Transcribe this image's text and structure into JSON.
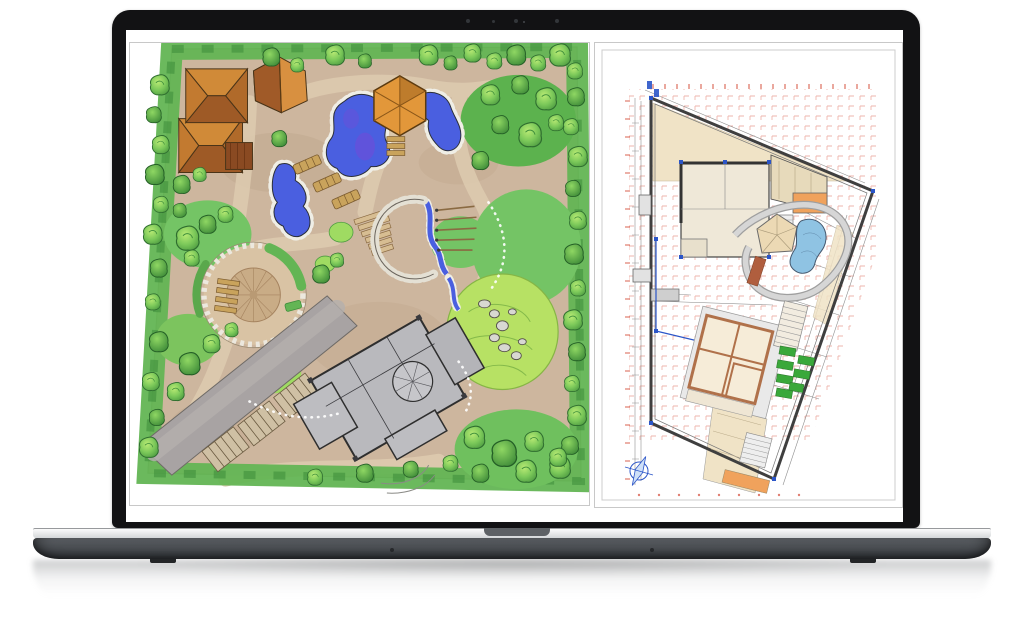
{
  "labels": {
    "laptop": "Laptop displaying a landscape design project",
    "screen": "Split screen with two garden plan images",
    "left_panel": "Hand-drawn landscape masterplan sketch with ponds, gazebo, houses and gray villa footprint",
    "right_panel": "CAD site plan drawing with red dimension grid, pool, gazebo and planting beds",
    "webcam": "webcam-dot"
  },
  "palette": {
    "bezel": "#121214",
    "screen-bg": "#ffffff",
    "panel-border": "#c8c8c8",
    "notch": "#5d6165",
    "base-top": "#5f6368",
    "base-bottom": "#2f3236",
    "feet": "#232527",
    "ground-tan": "#cdb69e",
    "path-tan": "#dcc9ae",
    "green-mid": "#63b554",
    "green-dark": "#3f8f3c",
    "green-bright": "#b7e164",
    "pond-blue": "#4a5fe0",
    "pond-purple": "#6a4fd8",
    "roof-dark": "#9e5a26",
    "roof-light": "#d08a38",
    "wood": "#c9a35c",
    "bldg-gray": "#b9b9bd",
    "road-gray": "#a8a3a3",
    "cad-beige": "#f0e3c6",
    "cad-room": "#f6ecd8",
    "cad-orange": "#f0a25c",
    "cad-green": "#3aa83a",
    "cad-pool": "#8fc3e3",
    "cad-wall-brown": "#b0714a",
    "cad-line": "#3f3f3f",
    "cad-red": "#d9604f",
    "cad-blue": "#2b55c8"
  }
}
